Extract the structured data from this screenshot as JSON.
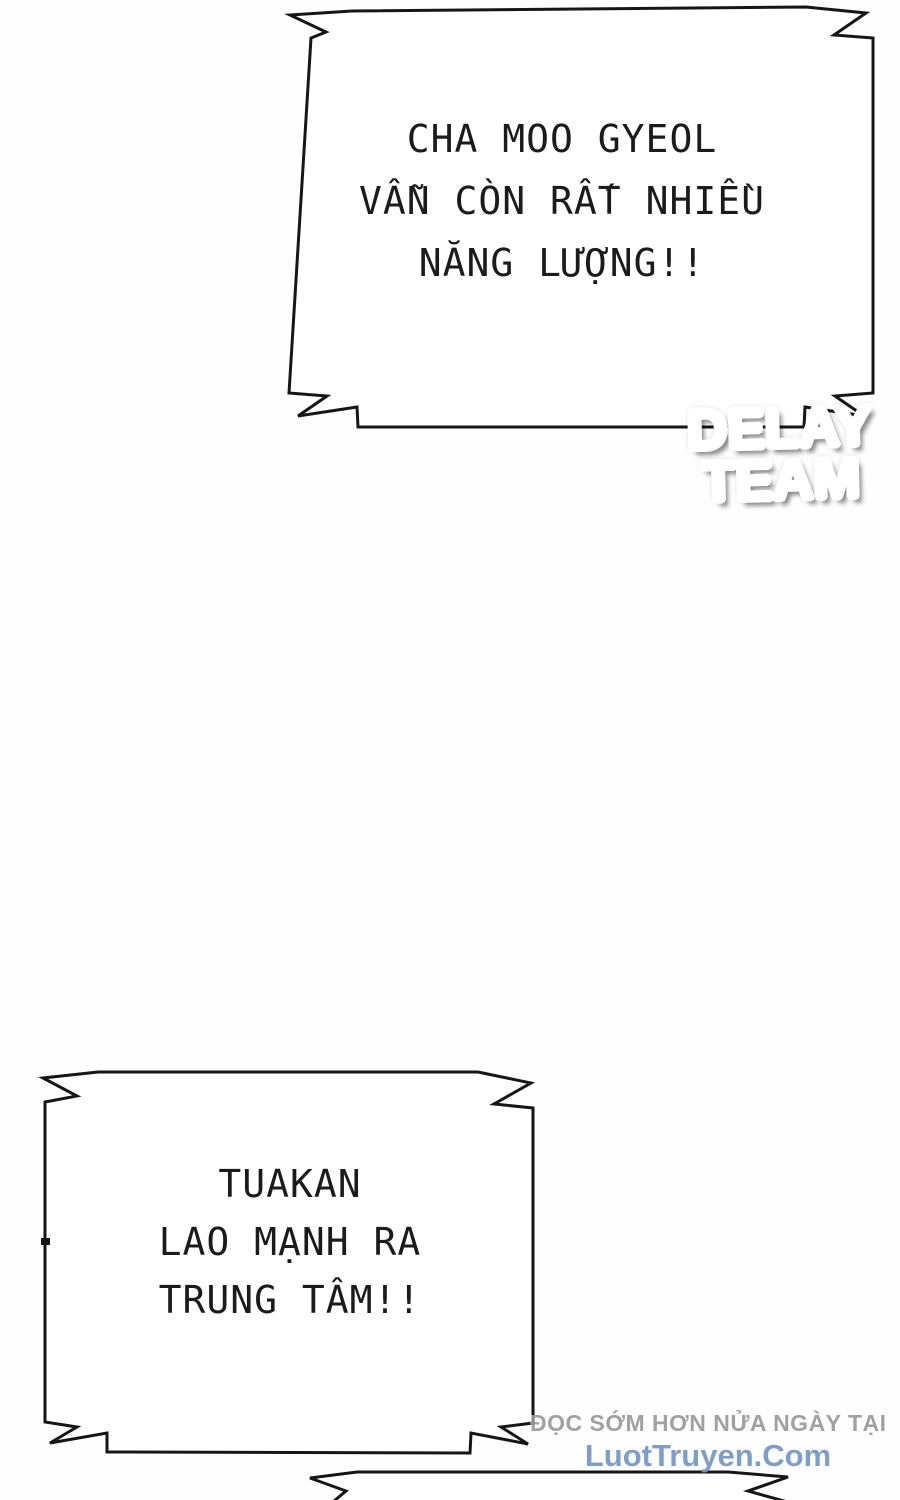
{
  "page": {
    "type": "comic-page",
    "background_color": "#fefefe",
    "ink_color": "#161616",
    "bubble_fill": "#ffffff",
    "text_color": "#1b1b1b"
  },
  "speech_bubbles": [
    {
      "id": "bubble-1",
      "lines": [
        "CHA MOO GYEOL",
        "VẪN CÒN RẤT NHIỀU",
        "NĂNG LƯỢNG!!"
      ]
    },
    {
      "id": "bubble-2",
      "lines": [
        "TUAKAN",
        "LAO MẠNH RA",
        "TRUNG TÂM!!"
      ]
    },
    {
      "id": "bubble-3-partial",
      "lines": []
    }
  ],
  "logo": {
    "line1_red": "D",
    "line1_dark": "ELAY",
    "line2_dark": "TEA",
    "line2_red": "M",
    "red_color": "#c2222b",
    "dark_color": "#141414",
    "outline_color": "#ffffff"
  },
  "watermark": {
    "line1": "ĐỌC SỚM HƠN NỬA NGÀY TẠI",
    "line2": "LuotTruyen.Com",
    "line1_color": "#9a9a9a",
    "line2_color": "#7495c6"
  }
}
